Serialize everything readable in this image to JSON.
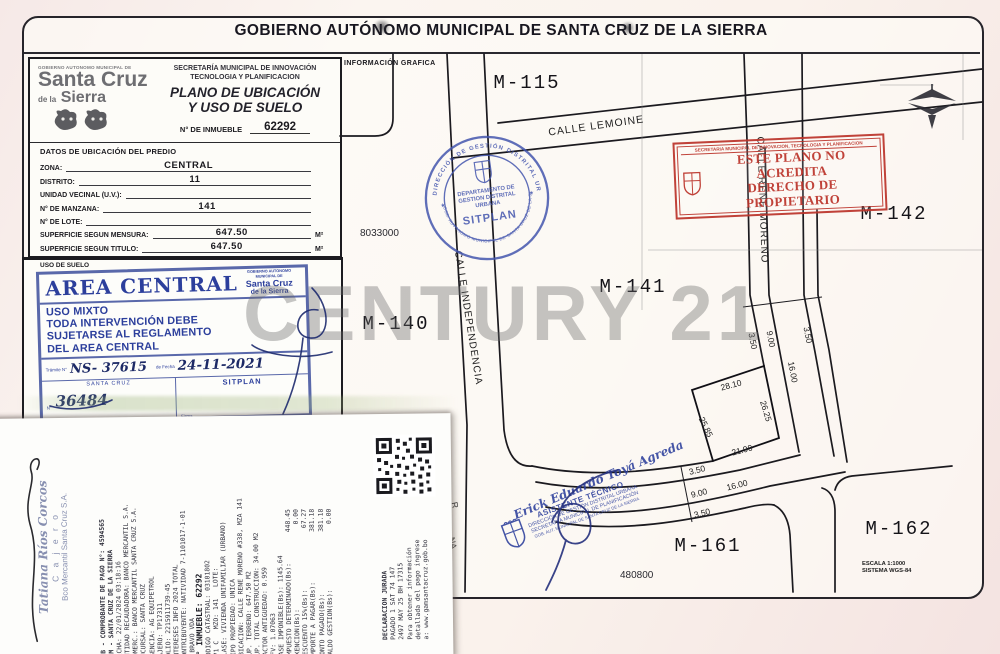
{
  "header": {
    "title": "GOBIERNO AUTÓNOMO MUNICIPAL DE SANTA CRUZ DE LA SIERRA"
  },
  "logo": {
    "tiny": "GOBIERNO AUTONOMO MUNICIPAL DE",
    "line1": "Santa Cruz",
    "de": "de la",
    "line2": "Sierra"
  },
  "secretariat": {
    "line1": "SECRETARÍA MUNICIPAL DE INNOVACIÓN",
    "line2": "TECNOLOGIA Y PLANIFICACION",
    "plan1": "PLANO DE UBICACIÓN",
    "plan2": "Y USO DE SUELO",
    "inmueble_label": "N° DE INMUEBLE",
    "inmueble_value": "62292"
  },
  "datos": {
    "title": "DATOS DE UBICACIÓN DEL PREDIO",
    "rows": [
      {
        "label": "ZONA:",
        "value": "CENTRAL",
        "suffix": ""
      },
      {
        "label": "DISTRITO:",
        "value": "11",
        "suffix": ""
      },
      {
        "label": "UNIDAD VECINAL (U.V.):",
        "value": "",
        "suffix": ""
      },
      {
        "label": "N° DE MANZANA:",
        "value": "141",
        "suffix": ""
      },
      {
        "label": "N° DE LOTE:",
        "value": "",
        "suffix": ""
      },
      {
        "label": "SUPERFICIE SEGUN MENSURA:",
        "value": "647.50",
        "suffix": "M²"
      },
      {
        "label": "SUPERFICIE SEGUN TITULO:",
        "value": "647.50",
        "suffix": "M²"
      }
    ]
  },
  "uso": {
    "section_label": "USO DE SUELO",
    "title": "AREA CENTRAL",
    "mini_logo": {
      "tiny": "GOBIERNO AUTONOMO MUNICIPAL DE",
      "l1": "Santa Cruz",
      "l2": "de la Sierra"
    },
    "rules": [
      "USO MIXTO",
      "TODA INTERVENCIÓN DEBE",
      "SUJETARSE AL REGLAMENTO",
      "DEL AREA CENTRAL"
    ],
    "tramite_label": "Trámite N°",
    "tramite_value": "NS- 37615",
    "fecha_label": "de Fecha",
    "fecha_value": "24-11-2021",
    "city": "SANTA CRUZ",
    "office": "SITPLAN",
    "num_label": "N°",
    "num_value": "36484",
    "firma_label": "Firma"
  },
  "map": {
    "info_label": "INFORMACIÓN GRAFICA",
    "blocks": [
      "M-115",
      "M-142",
      "M-141",
      "M-140",
      "M-161",
      "M-162"
    ],
    "streets": [
      "CALLE LEMOINE",
      "CALLE INDEPENDENCIA",
      "CALLE RENE MORENO"
    ],
    "coord_north": "8033000",
    "coord_south": "480800",
    "scale1": "ESCALA 1:1000",
    "scale2": "SISTEMA WGS-84",
    "lot_dims": [
      "28.10",
      "26.25",
      "25.85",
      "21.90"
    ],
    "upper_dims": [
      "3.50",
      "9.00",
      "3.50",
      "16.00"
    ],
    "lower_dims": [
      "3.50",
      "9.00",
      "16.00",
      "3.50"
    ],
    "fragments": [
      "R",
      "NA"
    ]
  },
  "stamps": {
    "round": {
      "ring_top": "DIRECCIÓN DE GESTIÓN DISTRITAL URBANA",
      "ring_bottom": "GOB. AUTONOMO MUNICIPAL DE SANTA CRUZ DE LA SIERRA",
      "center1": "DEPARTAMENTO DE",
      "center2": "GESTION DISTRITAL",
      "center3": "URBANA",
      "center4": "SITPLAN"
    },
    "red": {
      "top": "SECRETARIA MUNICIPAL DE INNOVACION, TECNOLOGIA Y PLANIFICACION",
      "line1": "ESTE PLANO NO ACREDITA",
      "line2": "DERECHO DE PROPIETARIO"
    },
    "assistant": {
      "name": "Erick Eduardo Toyá Agreda",
      "role": "ASISTENTE TÉCNICO",
      "l1": "DIRECCIÓN DE GESTIÓN DISTRITAL URBANA",
      "l2": "SECRETARÍA MUNICIPAL DE PLANIFICACIÓN",
      "l3": "GOB. AUT. MUNICIPAL DE SANTA CRUZ DE LA SIERRA"
    }
  },
  "watermark": "CENTURY 21",
  "receipt": {
    "cashier": {
      "name": "Tatiana Ríos Corcos",
      "role": "C a j e r o",
      "bank": "Bco Mercantil Santa Cruz S.A."
    },
    "lines": [
      "PUB - COMPROBANTE DE PAGO N°: 4594565",
      "GAM - SANTA CRUZ DE LA SIERRA",
      "FECHA: 22/01/2024 03:18:16",
      "ENTIDAD RECAUDADORA: BANCO MERCANTIL S.A.",
      "COMERC.: BANCO MERCANTIL SANTA CRUZ S.A.",
      "SUCURSAL: SANTA CRUZ",
      "AGENCIA: AG EQUIPETROL",
      "CAJERO: TP17311",
      "FOLIO: 2215911739-45",
      "INTERESES INFO 2024 TOTAL",
      "CONTRIBUYENTE: NATIVIDAD 7-1101017-1-01",
      "- BRAVO VDA",
      "N° INMUEBLE: 62292",
      "CODIGO CATASTRAL: 03101802",
      "271 C   MZO: 141   LOTE:",
      "CLASE: VIVIENDA UNIFAMILIAR (URBANO)",
      "TIPO PROPIEDAD: UNICA",
      "UBICACION: CALLE RENE MORENO #338, MZA 141",
      "SUP. TERRENO: 647.50 M2",
      "SUP. TOTAL CONSTRUCCION: 34.00 M2",
      "FACTOR ANTIGUEDAD: 0.959",
      "UFV: 1.07063",
      "BASE IMPONIBLE(Bs): 1145.64",
      "IMPUESTO DETERMINADO(Bs):        448.45",
      "EXENCION(Bs):                      0.00",
      "DESCUENTO 15%(Bs):                67.27",
      "IMPORTE A PAGAR(Bs):             381.18",
      "MONTO PAGADO(Bs):                381.18",
      "SALDO GESTION(Bs):                 0.00"
    ],
    "footer_lines": [
      "DECLARACION JURADA",
      "PAGADO 1 SAT 74 147",
      "2497 MAY 25 BH 17315",
      "Para obtener información",
      "detallada del pago ingrese",
      "a: www.gamsantacruz.gob.bo"
    ]
  }
}
